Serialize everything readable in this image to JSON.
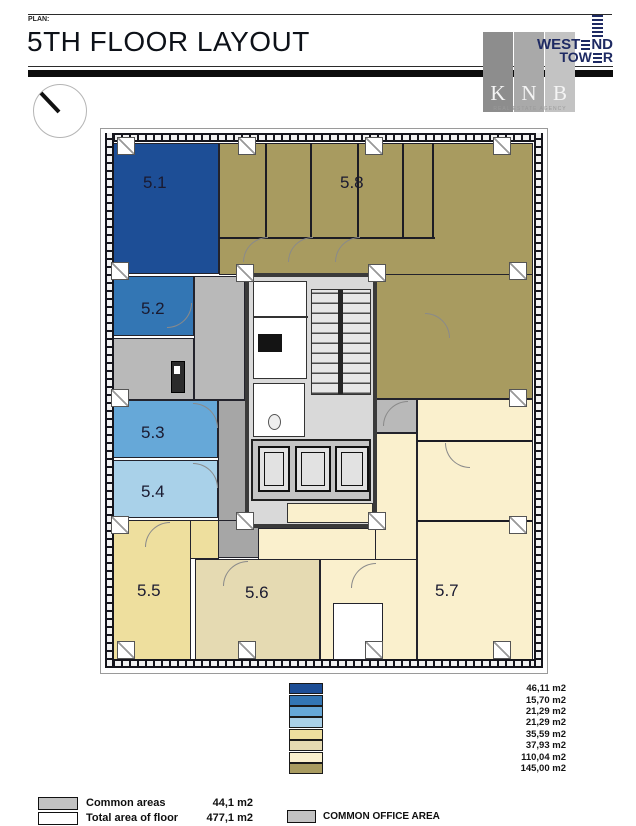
{
  "header": {
    "plan_label": "PLAN:",
    "title": "5TH FLOOR LAYOUT"
  },
  "logo": {
    "brand_word1_a": "WEST",
    "brand_word1_b": "ND",
    "brand_word2_a": "TOW",
    "brand_word2_b": "R",
    "agency_letters": [
      "K",
      "N",
      "B"
    ],
    "agency_tagline": "REAL ESTATE AGENCY",
    "brand_color": "#1e2a63"
  },
  "floor_plan": {
    "common_color": "#b9b9b9",
    "corridor_color": "#a6a6a6",
    "core_color": "#d9d9d9",
    "rooms": [
      {
        "id": "5.1",
        "area": "46,11 m2",
        "color": "#1d4e96"
      },
      {
        "id": "5.2",
        "area": "15,70 m2",
        "color": "#3376b4"
      },
      {
        "id": "5.3",
        "area": "21,29 m2",
        "color": "#66a8d8"
      },
      {
        "id": "5.4",
        "area": "21,29 m2",
        "color": "#a9d1e9"
      },
      {
        "id": "5.5",
        "area": "35,59 m2",
        "color": "#eedf9e"
      },
      {
        "id": "5.6",
        "area": "37,93 m2",
        "color": "#e5dab2"
      },
      {
        "id": "5.7",
        "area": "110,04 m2",
        "color": "#faf0cd"
      },
      {
        "id": "5.8",
        "area": "145,00 m2",
        "color": "#a89b60"
      }
    ]
  },
  "summary": {
    "common_areas_label": "Common areas",
    "common_areas_value": "44,1 m2",
    "total_label": "Total area of floor",
    "total_value": "477,1 m2",
    "common_office_label": "COMMON OFFICE AREA",
    "swatch_color": "#c2c2c2"
  }
}
